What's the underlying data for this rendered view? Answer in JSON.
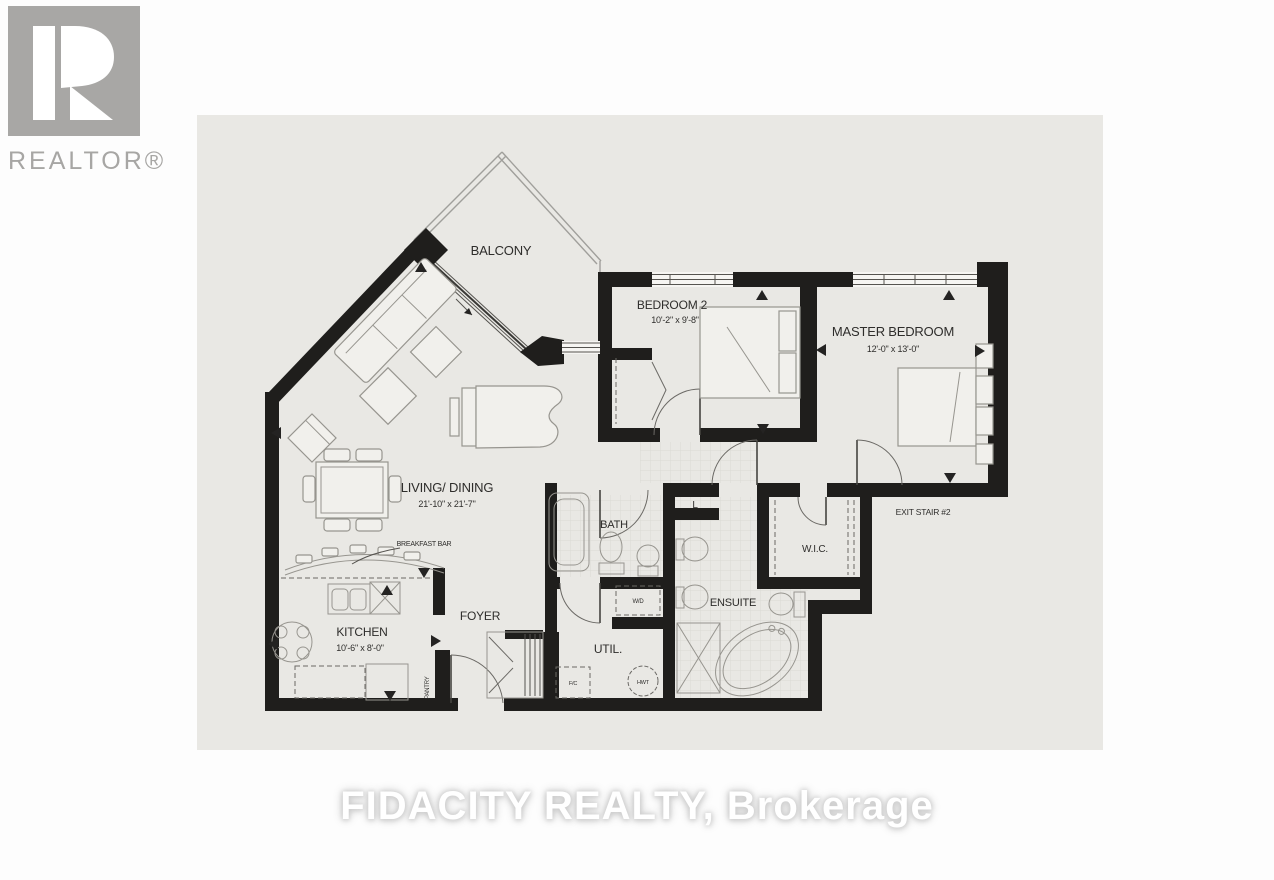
{
  "logo": {
    "text": "REALTOR®",
    "color": "#a7a6a4"
  },
  "watermark": {
    "text": "FIDACITY REALTY, Brokerage"
  },
  "plan": {
    "paper_color": "#e9e8e4",
    "wall_color": "#1f1e1c",
    "rooms": {
      "balcony": {
        "label": "BALCONY"
      },
      "bedroom2": {
        "label": "BEDROOM 2",
        "dims": "10'-2\" x 9'-8\""
      },
      "master": {
        "label": "MASTER BEDROOM",
        "dims": "12'-0\" x 13'-0\""
      },
      "living": {
        "label": "LIVING/ DINING",
        "dims": "21'-10\" x 21'-7\""
      },
      "kitchen": {
        "label": "KITCHEN",
        "dims": "10'-6\" x 8'-0\""
      },
      "foyer": {
        "label": "FOYER"
      },
      "bath": {
        "label": "BATH"
      },
      "ensuite": {
        "label": "ENSUITE"
      },
      "wic": {
        "label": "W.I.C."
      },
      "util": {
        "label": "UTIL."
      },
      "exit_stair": {
        "label": "EXIT STAIR #2"
      }
    },
    "features": {
      "breakfast_bar": "BREAKFAST BAR",
      "linen": "L",
      "washer_dryer": "W/D",
      "fridge_closet": "F/C",
      "hot_water_tank": "HWT",
      "pantry": "PANTRY"
    }
  }
}
